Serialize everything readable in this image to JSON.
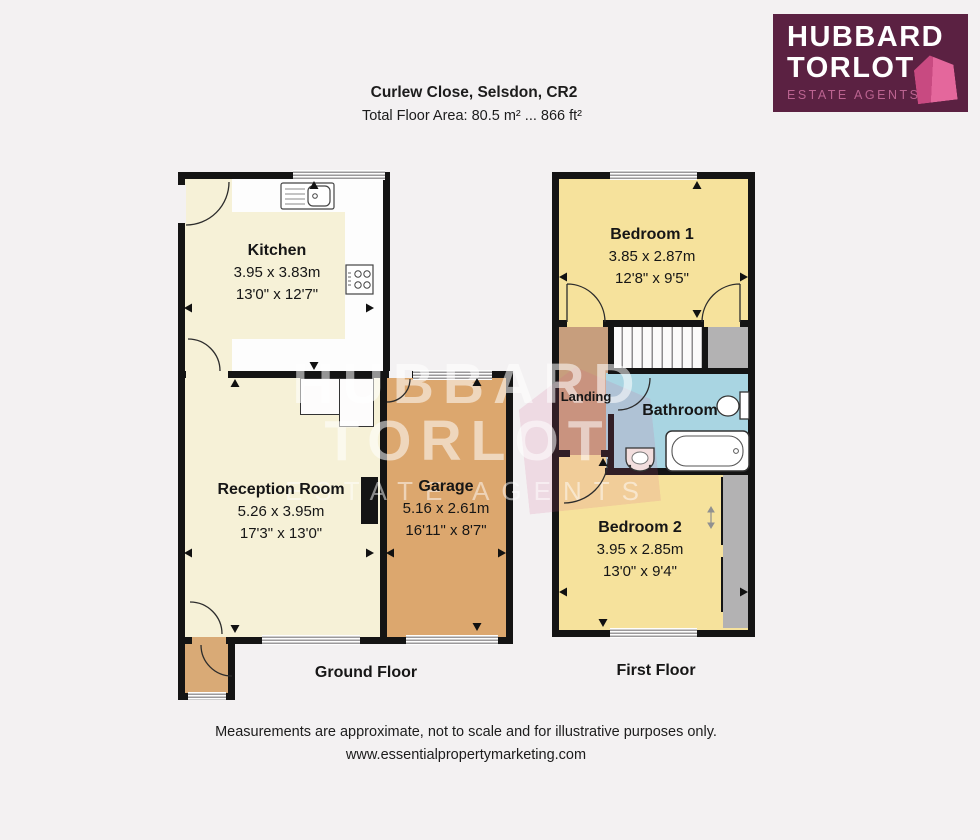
{
  "brand": {
    "logo": {
      "line1": "HUBBARD",
      "line2": "TORLOT",
      "tagline": "ESTATE AGENTS"
    },
    "colors": {
      "logo_background": "#5b2142",
      "logo_pink": "#d85690",
      "tagline_pink": "#bb6390"
    }
  },
  "header": {
    "title": "Curlew Close, Selsdon, CR2",
    "subtitle": "Total Floor Area: 80.5 m² ... 866 ft²"
  },
  "watermark": {
    "line1": "HUBBARD",
    "line2": "TORLOT",
    "line3": "ESTATE AGENTS"
  },
  "palette": {
    "room_cream": "#f6f1d7",
    "bedroom_yellow": "#f6e29c",
    "garage_tan": "#dca76e",
    "porch_tan": "#d9aa76",
    "landing_tan": "#c79e7d",
    "bathroom_blue": "#a9d5e2",
    "closet_gray": "#b3b2b3",
    "wall_black": "#141414"
  },
  "floors": {
    "ground": {
      "label": "Ground Floor",
      "rooms": {
        "kitchen": {
          "name": "Kitchen",
          "metric": "3.95 x 3.83m",
          "imperial": "13'0\" x 12'7\""
        },
        "reception": {
          "name": "Reception Room",
          "metric": "5.26 x 3.95m",
          "imperial": "17'3\" x 13'0\""
        },
        "garage": {
          "name": "Garage",
          "metric": "5.16 x 2.61m",
          "imperial": "16'11\" x 8'7\""
        }
      }
    },
    "first": {
      "label": "First Floor",
      "rooms": {
        "bedroom1": {
          "name": "Bedroom 1",
          "metric": "3.85 x 2.87m",
          "imperial": "12'8\" x 9'5\""
        },
        "landing": {
          "name": "Landing"
        },
        "bathroom": {
          "name": "Bathroom"
        },
        "bedroom2": {
          "name": "Bedroom 2",
          "metric": "3.95 x 2.85m",
          "imperial": "13'0\" x 9'4\""
        }
      }
    }
  },
  "footer": {
    "disclaimer": "Measurements are approximate, not to scale and for illustrative purposes only.",
    "website": "www.essentialpropertymarketing.com"
  }
}
